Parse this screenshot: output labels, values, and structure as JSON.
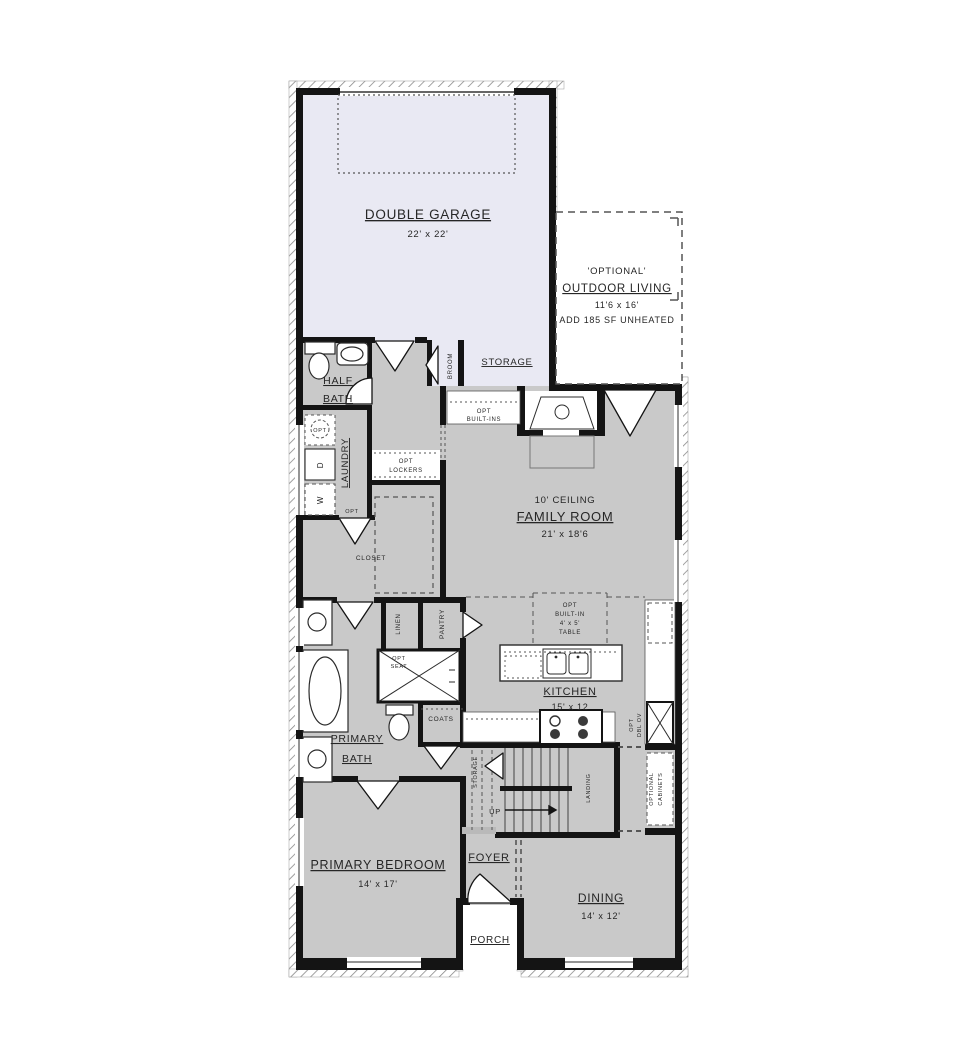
{
  "title": "First floor plan",
  "colors": {
    "wall": "#141414",
    "room_fill": "#c9c9c9",
    "garage_fill": "#e9e9f3",
    "dash": "#555555",
    "text": "#262626",
    "hatch": "#8a8a8a"
  },
  "plan": {
    "garage": {
      "title": "DOUBLE GARAGE",
      "dim": "22' x 22'"
    },
    "outdoor_living": {
      "tag": "'OPTIONAL'",
      "title": "OUTDOOR LIVING",
      "dim": "11'6 x 16'",
      "note": "ADD 185 SF UNHEATED"
    },
    "storage": {
      "title": "STORAGE"
    },
    "broom": {
      "title": "BROOM"
    },
    "half_bath": {
      "line1": "HALF",
      "line2": "BATH"
    },
    "laundry": {
      "title": "LAUNDRY"
    },
    "opt_sink": {
      "label": "OPT"
    },
    "dryer": {
      "label": "D"
    },
    "washer": {
      "label": "W"
    },
    "opt_door": {
      "label": "OPT"
    },
    "lockers": {
      "line1": "OPT",
      "line2": "LOCKERS"
    },
    "builtins": {
      "line1": "OPT",
      "line2": "BUILT-INS"
    },
    "family_room": {
      "ceiling": "10' CEILING",
      "title": "FAMILY ROOM",
      "dim": "21' x 18'6"
    },
    "closet": {
      "title": "CLOSET"
    },
    "linen": {
      "title": "LINEN"
    },
    "pantry": {
      "title": "PANTRY"
    },
    "opt_seat": {
      "line1": "OPT",
      "line2": "SEAT"
    },
    "opt_table": {
      "line1": "OPT",
      "line2": "BUILT-IN",
      "line3": "4' x 5'",
      "line4": "TABLE"
    },
    "kitchen": {
      "title": "KITCHEN",
      "dim": "15' x 12"
    },
    "opt_dbl_ov": {
      "line1": "OPT",
      "line2": "DBL OV"
    },
    "optional_cabinets": {
      "line1": "OPTIONAL",
      "line2": "CABINETS"
    },
    "coats": {
      "title": "COATS"
    },
    "stair_storage": {
      "title": "STORAGE"
    },
    "landing": {
      "title": "LANDING"
    },
    "up": {
      "label": "UP"
    },
    "primary_bath": {
      "line1": "PRIMARY",
      "line2": "BATH"
    },
    "primary_bedroom": {
      "title": "PRIMARY BEDROOM",
      "dim": "14' x 17'"
    },
    "foyer": {
      "title": "FOYER"
    },
    "dining": {
      "title": "DINING",
      "dim": "14' x 12'"
    },
    "porch": {
      "title": "PORCH"
    }
  }
}
